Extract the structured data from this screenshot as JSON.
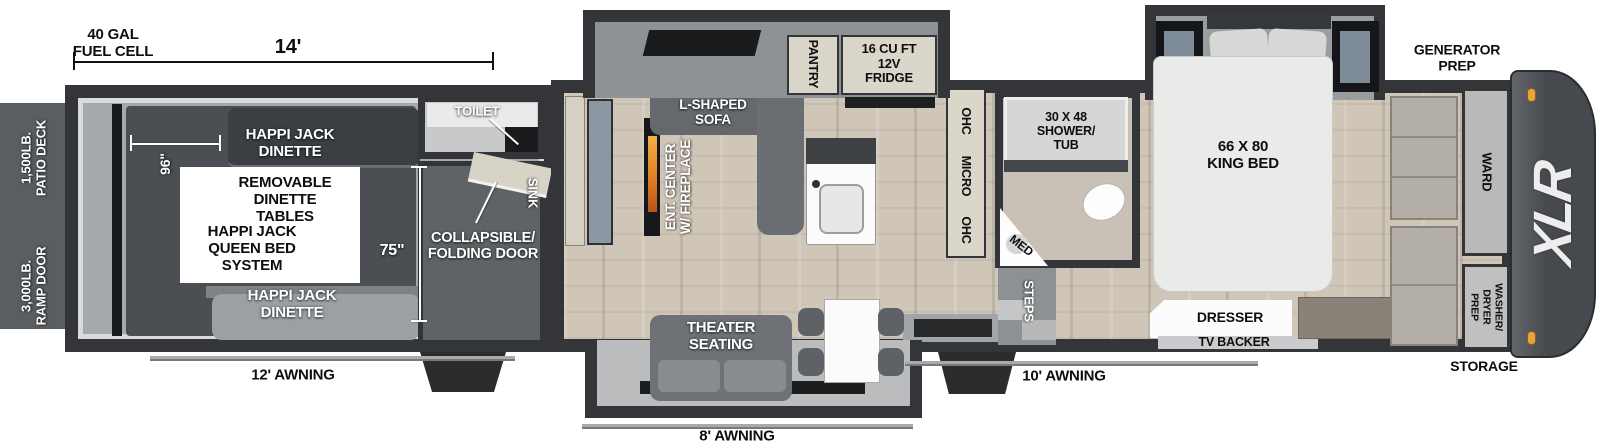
{
  "annotations": {
    "fuel_cell": "40 GAL\nFUEL CELL",
    "dim_length": "14'",
    "generator_prep": "GENERATOR\nPREP",
    "patio_deck": "1,500LB.\nPATIO DECK",
    "ramp_door": "3,000LB.\nRAMP DOOR",
    "awning_garage": "12' AWNING",
    "awning_main": "8' AWNING",
    "awning_door": "10' AWNING",
    "storage": "STORAGE",
    "brand_logo": "XLR"
  },
  "garage": {
    "dinette_top": "HAPPI JACK\nDINETTE",
    "removable_tables": "REMOVABLE\nDINETTE\nTABLES",
    "queen_bed": "HAPPI JACK\nQUEEN BED\nSYSTEM",
    "dinette_bottom": "HAPPI JACK\nDINETTE",
    "dim_width": "96\"",
    "dim_height": "75\"",
    "toilet": "TOILET",
    "sink": "SINK",
    "folding_door": "COLLAPSIBLE/\nFOLDING DOOR"
  },
  "living": {
    "sofa": "L-SHAPED\nSOFA",
    "ent_center": "ENT. CENTER\nW/ FIREPLACE",
    "pantry": "PANTRY",
    "fridge": "16 CU FT\n12V\nFRIDGE",
    "ohc_left": "OHC",
    "micro": "MICRO",
    "ohc_right": "OHC",
    "theater": "THEATER\nSEATING"
  },
  "bathroom": {
    "shower": "30 X 48\nSHOWER/\nTUB",
    "med": "MED",
    "steps": "STEPS"
  },
  "bedroom": {
    "bed": "66 X 80\nKING BED",
    "dresser": "DRESSER",
    "tv_backer": "TV BACKER",
    "ward": "WARD",
    "washer_dryer": "WASHER/\nDRYER\nPREP"
  },
  "colors": {
    "wall": "#333538",
    "floor_wood": "#d0c6b8",
    "garage_floor": "#a6a9ab",
    "clearance_light": "#e9a43e",
    "cap": "#46494d"
  }
}
